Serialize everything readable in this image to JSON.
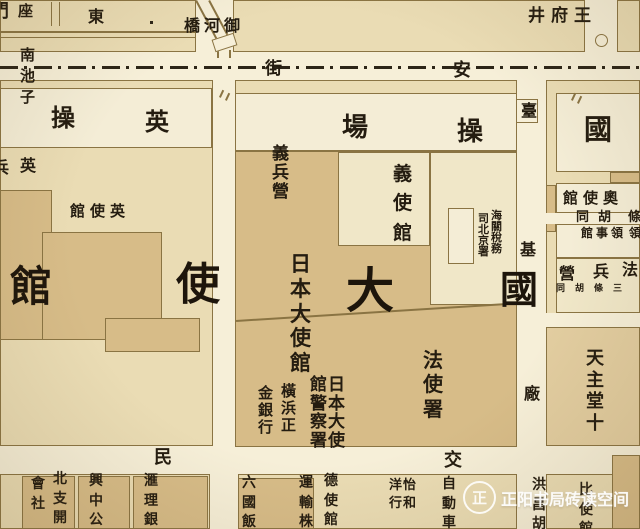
{
  "map": {
    "palette": {
      "street": "#f6efd8",
      "block": "#eadcb4",
      "white": "#f4edd6",
      "pale": "#f0e7c8",
      "tan": "#d7bc88",
      "church": "#e2cda0",
      "line": "#8a7443",
      "ink": "#241c10",
      "dash": "#2c2517"
    },
    "blocks": [
      {
        "n": "block-nw",
        "x": 0,
        "y": 0,
        "w": 196,
        "h": 52
      },
      {
        "n": "block-n-center",
        "x": 233,
        "y": 0,
        "w": 352,
        "h": 52
      },
      {
        "n": "block-ne",
        "x": 617,
        "y": 0,
        "w": 23,
        "h": 52
      },
      {
        "n": "block-british-legation",
        "x": 0,
        "y": 80,
        "w": 213,
        "h": 366
      },
      {
        "n": "block-central",
        "x": 235,
        "y": 80,
        "w": 282,
        "h": 366
      },
      {
        "n": "block-east",
        "x": 546,
        "y": 80,
        "w": 94,
        "h": 366
      },
      {
        "n": "block-sw-bottom",
        "x": 0,
        "y": 474,
        "w": 210,
        "h": 55
      },
      {
        "n": "block-s-center-bottom",
        "x": 238,
        "y": 474,
        "w": 279,
        "h": 55
      },
      {
        "n": "block-se-bottom",
        "x": 546,
        "y": 474,
        "w": 94,
        "h": 55
      },
      {
        "n": "drill-ground-west",
        "x": 0,
        "y": 88,
        "w": 212,
        "h": 60,
        "f": "white"
      },
      {
        "n": "drill-ground-east",
        "x": 235,
        "y": 93,
        "w": 282,
        "h": 58,
        "f": "white"
      },
      {
        "n": "japanese-embassy-compound",
        "x": 235,
        "y": 151,
        "w": 282,
        "h": 296,
        "f": "tan",
        "hatch": 1
      },
      {
        "n": "italian-legation-block",
        "x": 338,
        "y": 152,
        "w": 92,
        "h": 94,
        "f": "pale"
      },
      {
        "n": "customs-block",
        "x": 430,
        "y": 152,
        "w": 87,
        "h": 153,
        "f": "pale"
      },
      {
        "n": "customs-building",
        "x": 448,
        "y": 208,
        "w": 26,
        "h": 56,
        "f": "white"
      },
      {
        "n": "british-building-1",
        "x": 0,
        "y": 190,
        "w": 52,
        "h": 150,
        "f": "tan"
      },
      {
        "n": "british-building-2",
        "x": 42,
        "y": 232,
        "w": 120,
        "h": 108,
        "f": "tan"
      },
      {
        "n": "british-building-3",
        "x": 105,
        "y": 318,
        "w": 95,
        "h": 34,
        "f": "tan"
      },
      {
        "n": "ne-white-block",
        "x": 556,
        "y": 93,
        "w": 84,
        "h": 79,
        "f": "white"
      },
      {
        "n": "ne-hatch-patch",
        "x": 610,
        "y": 172,
        "w": 30,
        "h": 11,
        "f": "tan",
        "hatch": 2
      },
      {
        "n": "east-sliver",
        "x": 546,
        "y": 185,
        "w": 10,
        "h": 47,
        "f": "tan",
        "hatch": 2
      },
      {
        "n": "austrian-legation-block",
        "x": 556,
        "y": 183,
        "w": 84,
        "h": 30,
        "f": "white"
      },
      {
        "n": "lane-east-1",
        "x": 546,
        "y": 213,
        "w": 94,
        "h": 11,
        "f": "street",
        "bw": 0
      },
      {
        "n": "consulate-block",
        "x": 556,
        "y": 224,
        "w": 84,
        "h": 34,
        "f": "white"
      },
      {
        "n": "french-barracks-block",
        "x": 556,
        "y": 258,
        "w": 84,
        "h": 55,
        "f": "pale"
      },
      {
        "n": "lane-east-2",
        "x": 546,
        "y": 313,
        "w": 94,
        "h": 14,
        "f": "street",
        "bw": 0
      },
      {
        "n": "church-block",
        "x": 546,
        "y": 327,
        "w": 94,
        "h": 119,
        "f": "church",
        "hatch": 1
      },
      {
        "n": "bottom-tan-1",
        "x": 22,
        "y": 476,
        "w": 53,
        "h": 53,
        "f": "tan"
      },
      {
        "n": "bottom-tan-2",
        "x": 78,
        "y": 476,
        "w": 52,
        "h": 53,
        "f": "tan"
      },
      {
        "n": "bottom-tan-3",
        "x": 133,
        "y": 476,
        "w": 75,
        "h": 53,
        "f": "tan"
      },
      {
        "n": "bottom-tan-4",
        "x": 238,
        "y": 478,
        "w": 76,
        "h": 51,
        "f": "tan"
      },
      {
        "n": "se-hatch-block",
        "x": 612,
        "y": 455,
        "w": 28,
        "h": 74,
        "f": "tan",
        "hatch": 2
      }
    ],
    "symbols": [
      {
        "t": "dash",
        "x": 0,
        "y": 66,
        "w": 640,
        "h": 3,
        "n": "changan-tram-centerline"
      },
      {
        "t": "line",
        "x": 197,
        "y": 0,
        "len": 46,
        "th": 1.6,
        "ang": 62,
        "n": "canal-line-west"
      },
      {
        "t": "line",
        "x": 210,
        "y": 0,
        "len": 45,
        "th": 1.6,
        "ang": 62,
        "n": "canal-line-east"
      },
      {
        "t": "line",
        "x": 219,
        "y": 50,
        "len": 8,
        "th": 1.6,
        "ang": 90,
        "n": "canal-stub-west"
      },
      {
        "t": "line",
        "x": 231,
        "y": 50,
        "len": 8,
        "th": 1.6,
        "ang": 90,
        "n": "canal-stub-east"
      },
      {
        "t": "rect",
        "x": 213,
        "y": 36,
        "w": 23,
        "h": 13,
        "ang": -18,
        "n": "yuhe-bridge"
      },
      {
        "t": "circle",
        "x": 595,
        "y": 34,
        "d": 13,
        "n": "wangfujing-junction"
      },
      {
        "t": "line",
        "x": 0,
        "y": 31,
        "len": 196,
        "th": 1.5,
        "ang": 0,
        "n": "street-line-a"
      },
      {
        "t": "line",
        "x": 0,
        "y": 37,
        "len": 196,
        "th": 1,
        "ang": 0,
        "n": "street-line-b"
      },
      {
        "t": "line",
        "x": 52,
        "y": 2,
        "len": 24,
        "th": 1.2,
        "ang": 90,
        "n": "street-line-c"
      },
      {
        "t": "line",
        "x": 60,
        "y": 2,
        "len": 24,
        "th": 1.2,
        "ang": 90,
        "n": "street-line-d"
      },
      {
        "t": "line",
        "x": 236,
        "y": 320,
        "len": 281,
        "th": 1.8,
        "ang": -3.6,
        "n": "compound-boundary"
      },
      {
        "t": "box",
        "x": 516,
        "y": 99,
        "w": 22,
        "h": 24,
        "n": "taiji-gate-box"
      },
      {
        "t": "rect",
        "x": 150,
        "y": 21,
        "w": 3,
        "h": 3,
        "f": "#2c2517",
        "bw": 0,
        "n": "map-dot"
      },
      {
        "t": "line",
        "x": 219,
        "y": 97,
        "len": 8,
        "th": 1.5,
        "ang": -65,
        "n": "tram-tick-1"
      },
      {
        "t": "line",
        "x": 225,
        "y": 100,
        "len": 8,
        "th": 1.5,
        "ang": -65,
        "n": "tram-tick-2"
      },
      {
        "t": "line",
        "x": 571,
        "y": 100,
        "len": 8,
        "th": 1.5,
        "ang": -65,
        "n": "tram-tick-3"
      },
      {
        "t": "line",
        "x": 577,
        "y": 103,
        "len": 8,
        "th": 1.5,
        "ang": -65,
        "n": "tram-tick-4"
      }
    ],
    "labels": [
      {
        "n": "label-gate-partial",
        "t": "門",
        "x": -9,
        "y": 3,
        "s": 18
      },
      {
        "n": "label-zuo",
        "t": "座",
        "x": 18,
        "y": 4,
        "s": 15
      },
      {
        "n": "label-dong",
        "t": "東",
        "x": 88,
        "y": 9,
        "s": 16
      },
      {
        "n": "label-yuhe-bridge",
        "t": "橋河御",
        "x": 184,
        "y": 18,
        "s": 16,
        "ls": 4
      },
      {
        "n": "label-wangfujing",
        "t": "井府王",
        "x": 528,
        "y": 8,
        "s": 17,
        "ls": 6
      },
      {
        "n": "label-nanchizi",
        "t": "南池子",
        "x": 19,
        "y": 45,
        "s": 15,
        "dir": "v",
        "lh": 1.4
      },
      {
        "n": "label-street-jie",
        "t": "街",
        "x": 265,
        "y": 61,
        "s": 17
      },
      {
        "n": "label-street-an",
        "t": "安",
        "x": 453,
        "y": 62,
        "s": 18
      },
      {
        "n": "label-drill-cao-w",
        "t": "操",
        "x": 51,
        "y": 106,
        "s": 24
      },
      {
        "n": "label-drill-ying-w",
        "t": "英",
        "x": 145,
        "y": 110,
        "s": 24
      },
      {
        "n": "label-drill-chang",
        "t": "場",
        "x": 342,
        "y": 115,
        "s": 26
      },
      {
        "n": "label-drill-cao-e",
        "t": "操",
        "x": 457,
        "y": 119,
        "s": 26
      },
      {
        "n": "label-guo-ne",
        "t": "國",
        "x": 584,
        "y": 116,
        "s": 28
      },
      {
        "n": "label-tai",
        "t": "臺",
        "x": 521,
        "y": 103,
        "s": 16
      },
      {
        "n": "label-yi-barracks",
        "t": "義兵營",
        "x": 271,
        "y": 145,
        "s": 17,
        "dir": "v",
        "lh": 1.13
      },
      {
        "n": "label-yi-legation",
        "t": "義使館",
        "x": 392,
        "y": 160,
        "s": 19,
        "dir": "v",
        "lh": 1.55
      },
      {
        "n": "label-ying-partial",
        "t": "兵",
        "x": -7,
        "y": 160,
        "s": 16
      },
      {
        "n": "label-ying",
        "t": "英",
        "x": 20,
        "y": 158,
        "s": 16
      },
      {
        "n": "label-british-legation",
        "t": "館使英",
        "x": 70,
        "y": 204,
        "s": 15,
        "ls": 5
      },
      {
        "n": "label-austrian-legation",
        "t": "館使奧",
        "x": 563,
        "y": 191,
        "s": 15,
        "ls": 5
      },
      {
        "n": "label-hutong",
        "t": "同胡",
        "x": 576,
        "y": 211,
        "s": 13,
        "ls": 9
      },
      {
        "n": "label-hutong-partial",
        "t": "條",
        "x": 628,
        "y": 211,
        "s": 13
      },
      {
        "n": "label-consulate",
        "t": "館事領",
        "x": 581,
        "y": 227,
        "s": 12,
        "ls": 3
      },
      {
        "n": "label-consulate-partial",
        "t": "領",
        "x": 629,
        "y": 227,
        "s": 12
      },
      {
        "n": "label-customs-1",
        "t": "海關稅務",
        "x": 490,
        "y": 210,
        "s": 11,
        "dir": "v",
        "lh": 1.0
      },
      {
        "n": "label-customs-2",
        "t": "司北京署",
        "x": 477,
        "y": 213,
        "s": 11,
        "dir": "v",
        "lh": 1.0
      },
      {
        "n": "label-japanese-embassy",
        "t": "日本大使館",
        "x": 289,
        "y": 252,
        "s": 21,
        "dir": "v",
        "lh": 1.18
      },
      {
        "n": "label-big-guan",
        "t": "館",
        "x": 10,
        "y": 266,
        "s": 42,
        "big": 1
      },
      {
        "n": "label-big-shi",
        "t": "使",
        "x": 176,
        "y": 263,
        "s": 44,
        "big": 1
      },
      {
        "n": "label-big-da",
        "t": "大",
        "x": 346,
        "y": 267,
        "s": 48,
        "big": 1
      },
      {
        "n": "label-big-guo",
        "t": "國",
        "x": 500,
        "y": 271,
        "s": 38,
        "big": 1
      },
      {
        "n": "label-ji",
        "t": "基",
        "x": 520,
        "y": 242,
        "s": 16
      },
      {
        "n": "label-fa-barracks-ying",
        "t": "營",
        "x": 559,
        "y": 266,
        "s": 16
      },
      {
        "n": "label-fa-barracks-bing",
        "t": "兵",
        "x": 593,
        "y": 264,
        "s": 16
      },
      {
        "n": "label-fa-barracks-fa",
        "t": "法",
        "x": 622,
        "y": 262,
        "s": 16
      },
      {
        "n": "label-tiny-hutong",
        "t": "同胡條三",
        "x": 556,
        "y": 285,
        "s": 9,
        "ls": 10
      },
      {
        "n": "label-french-legation",
        "t": "法使署",
        "x": 422,
        "y": 348,
        "s": 20,
        "dir": "v",
        "lh": 1.22
      },
      {
        "n": "label-chang",
        "t": "廠",
        "x": 524,
        "y": 386,
        "s": 16
      },
      {
        "n": "label-catholic-church",
        "t": "天主堂十",
        "x": 585,
        "y": 348,
        "s": 18,
        "dir": "v",
        "lh": 1.2
      },
      {
        "n": "label-jp-police-1",
        "t": "日本大使",
        "x": 327,
        "y": 376,
        "s": 17,
        "dir": "v",
        "lh": 1.1
      },
      {
        "n": "label-jp-police-2",
        "t": "館警察署",
        "x": 309,
        "y": 376,
        "s": 17,
        "dir": "v",
        "lh": 1.1
      },
      {
        "n": "label-yokohama-1",
        "t": "橫浜正",
        "x": 280,
        "y": 383,
        "s": 15,
        "dir": "v",
        "lh": 1.13
      },
      {
        "n": "label-yokohama-2",
        "t": "金銀行",
        "x": 257,
        "y": 385,
        "s": 15,
        "dir": "v",
        "lh": 1.13
      },
      {
        "n": "label-street-min",
        "t": "民",
        "x": 154,
        "y": 449,
        "s": 18
      },
      {
        "n": "label-street-jiao",
        "t": "交",
        "x": 444,
        "y": 452,
        "s": 18
      },
      {
        "n": "label-huishe",
        "t": "會社",
        "x": 30,
        "y": 475,
        "s": 14,
        "dir": "v",
        "lh": 1.4
      },
      {
        "n": "label-beizhi",
        "t": "北支開",
        "x": 52,
        "y": 470,
        "s": 14,
        "dir": "v",
        "lh": 1.4
      },
      {
        "n": "label-xingzhong",
        "t": "興中公",
        "x": 88,
        "y": 472,
        "s": 14,
        "dir": "v",
        "lh": 1.4
      },
      {
        "n": "label-huili",
        "t": "滙理銀",
        "x": 143,
        "y": 472,
        "s": 14,
        "dir": "v",
        "lh": 1.4
      },
      {
        "n": "label-liuguo-hotel",
        "t": "六國飯",
        "x": 241,
        "y": 474,
        "s": 14,
        "dir": "v",
        "lh": 1.4
      },
      {
        "n": "label-yunshu",
        "t": "運輸株",
        "x": 298,
        "y": 474,
        "s": 14,
        "dir": "v",
        "lh": 1.4
      },
      {
        "n": "label-german-legation",
        "t": "德使館",
        "x": 323,
        "y": 472,
        "s": 14,
        "dir": "v",
        "lh": 1.4
      },
      {
        "n": "label-yihe",
        "t": "怡和",
        "x": 402,
        "y": 477,
        "s": 13,
        "dir": "v",
        "lh": 1.35
      },
      {
        "n": "label-yanghang",
        "t": "洋行",
        "x": 388,
        "y": 477,
        "s": 13,
        "dir": "v",
        "lh": 1.35
      },
      {
        "n": "label-automobile",
        "t": "自動車",
        "x": 441,
        "y": 475,
        "s": 14,
        "dir": "v",
        "lh": 1.4
      },
      {
        "n": "label-hongchang",
        "t": "洪昌胡",
        "x": 531,
        "y": 476,
        "s": 14,
        "dir": "v",
        "lh": 1.4
      },
      {
        "n": "label-belgian-legation",
        "t": "比使館",
        "x": 578,
        "y": 481,
        "s": 14,
        "dir": "v",
        "lh": 1.4
      }
    ]
  },
  "watermark": {
    "text": "正阳书局砖读空间",
    "logo_char": "正"
  }
}
